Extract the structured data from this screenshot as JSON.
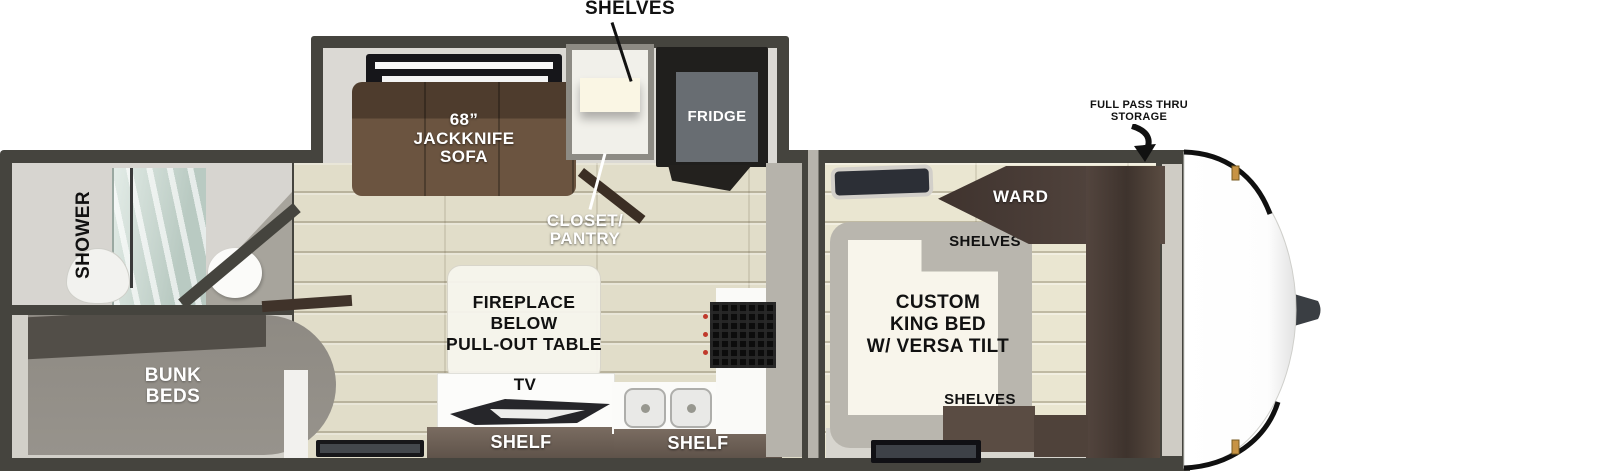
{
  "title": "Travel trailer floor plan",
  "colors": {
    "wall": "#45443e",
    "floor_wood": "#e1ddc9",
    "sofa_brown": "#5f4a38",
    "shelf_brown": "#6e6157",
    "wardrobe_brown": "#4c3f39",
    "bunk_gray": "#8f8b84",
    "bed_white": "#f8f5eb",
    "marker_light_amber": "#c79344"
  },
  "callouts": {
    "shelves": "SHELVES",
    "storage_line1": "FULL PASS THRU",
    "storage_line2": "STORAGE"
  },
  "bathroom": {
    "shower": "SHOWER"
  },
  "bunk": {
    "line1": "BUNK",
    "line2": "BEDS"
  },
  "living": {
    "sofa_line1": "68”",
    "sofa_line2": "JACKKNIFE",
    "sofa_line3": "SOFA",
    "fridge": "FRIDGE",
    "closet_line1": "CLOSET/",
    "closet_line2": "PANTRY",
    "table_line1": "FIREPLACE",
    "table_line2": "BELOW",
    "table_line3": "PULL-OUT TABLE",
    "tv": "TV",
    "shelf": "SHELF"
  },
  "kitchen": {
    "shelf": "SHELF"
  },
  "bedroom": {
    "shelves_top": "SHELVES",
    "bed_line1": "CUSTOM",
    "bed_line2": "KING BED",
    "bed_line3": "W/ VERSA TILT",
    "shelves_bottom": "SHELVES",
    "ward": "WARD"
  }
}
